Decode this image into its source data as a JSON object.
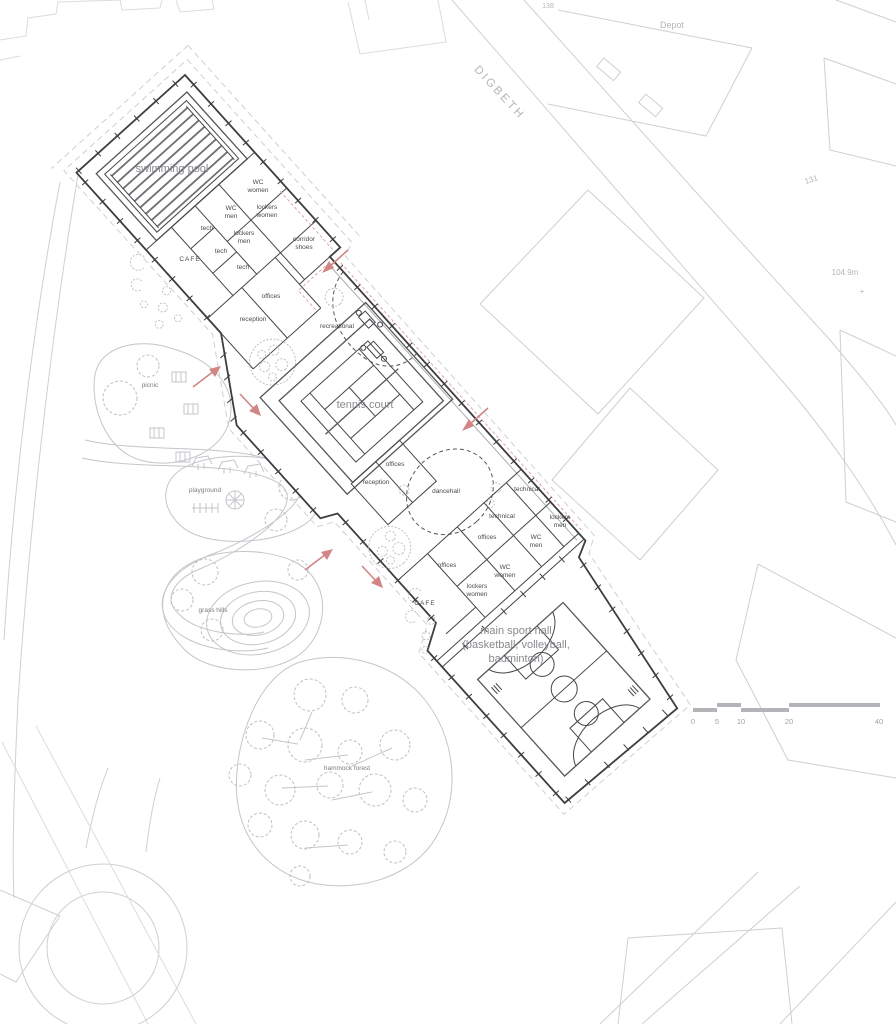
{
  "drawing": {
    "context": {
      "street": "DIGBETH",
      "depot": "Depot",
      "building_138": "138",
      "building_131": "131",
      "elevation": "104.9m",
      "plus_mark": "+"
    },
    "rooms": {
      "wc": "WC",
      "women": "women",
      "men": "men",
      "lockers": "lockers",
      "tech": "tech",
      "cafe": "CAFE",
      "corridor": "corridor",
      "shoes": "shoes",
      "offices": "offices",
      "reception": "reception",
      "recreational": "recreational",
      "technical": "technical",
      "dancehall": "dancehall"
    },
    "halls": {
      "swimming_pool": "swimming pool",
      "tennis_court": "tennis court",
      "main_hall_line1": "main sport hall",
      "main_hall_line2": "(basketball, volleyball,",
      "main_hall_line3": "badminton)"
    },
    "park": {
      "picnic": "picnic",
      "playground": "playground",
      "grass_hills": "grass hills",
      "hammock_forest": "hammock forest"
    },
    "scalebar": {
      "s0": "0",
      "s5": "5",
      "s10": "10",
      "s20": "20",
      "s40": "40"
    },
    "colors": {
      "wall": "#3d3d42",
      "context_line": "#cfcfd4",
      "park_line": "#c5c5cb",
      "entrance_arrow_red": "#d28585",
      "scalebar_gray": "#b4b4b8"
    }
  }
}
